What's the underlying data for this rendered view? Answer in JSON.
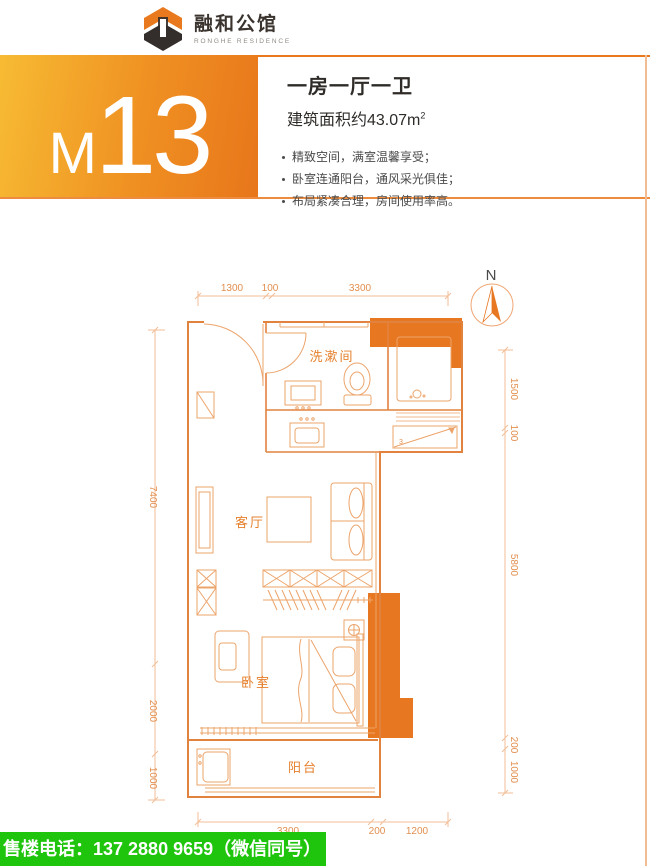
{
  "brand": {
    "name": "融和公馆",
    "subtitle": "RONGHE RESIDENCE"
  },
  "hero": {
    "unit_prefix": "M",
    "unit_number": "13",
    "title": "一房一厅一卫",
    "area_text": "建筑面积约43.07m",
    "area_sup": "2",
    "features": [
      "精致空间，满室温馨享受；",
      "卧室连通阳台，通风采光俱佳；",
      "布局紧凑合理，房间使用率高。"
    ]
  },
  "plan": {
    "north_label": "N",
    "rooms": {
      "washroom": "洗漱间",
      "living": "客厅",
      "bedroom": "卧室",
      "balcony": "阳台"
    },
    "dims": {
      "top": [
        "1300",
        "100",
        "3300"
      ],
      "bottom": [
        "3300",
        "200",
        "1200"
      ],
      "left": [
        "7400",
        "2000",
        "1000"
      ],
      "right": [
        "1500",
        "100",
        "5800",
        "200",
        "1000"
      ]
    },
    "storage_mark": "3"
  },
  "footer": {
    "phone": "售楼电话：137 2880 9659（微信同号）"
  },
  "colors": {
    "accent": "#E87722",
    "gradient_start": "#F7BB33",
    "gradient_end": "#E8761B",
    "footer_green": "#1EC50C",
    "plan_line": "#E2823F"
  }
}
